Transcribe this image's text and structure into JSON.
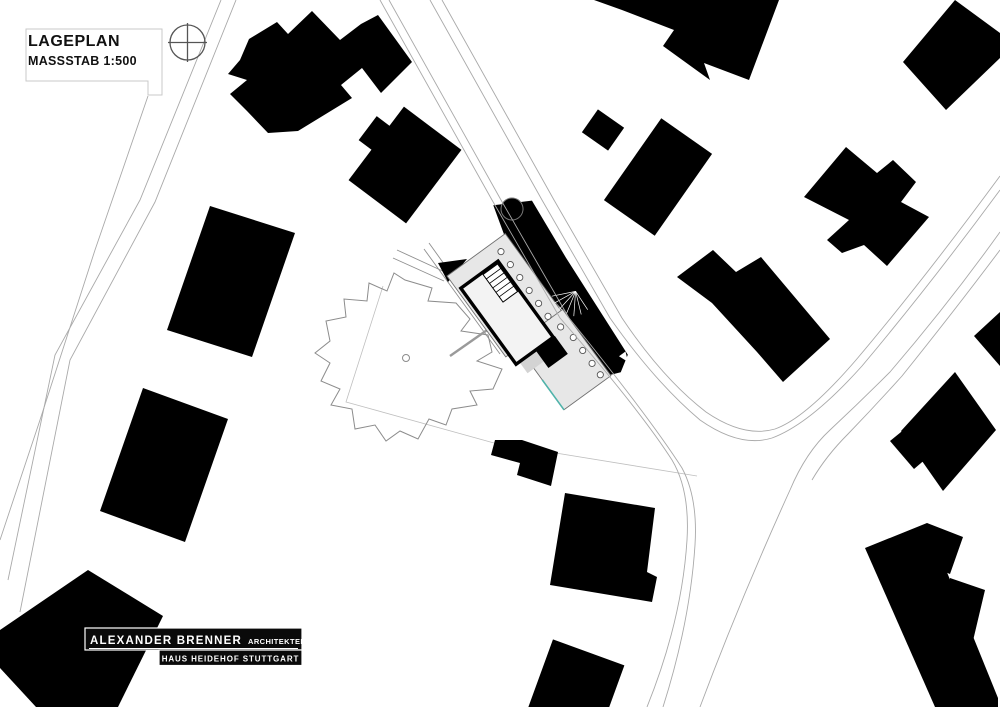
{
  "title_block": {
    "title": "LAGEPLAN",
    "scale": "MASSSTAB 1:500"
  },
  "stamp": {
    "firm": "ALEXANDER BRENNER",
    "firm_suffix": "ARCHITEKTEN",
    "project": "HAUS HEIDEHOF STUTTGART"
  },
  "icons": {
    "survey_marker": "crosshair-circle-icon"
  },
  "colors": {
    "background": "#ffffff",
    "building_fill": "#000000",
    "road_line": "#a9a9a9",
    "boundary_line": "#bfbfbf",
    "tree_line": "#8c8c8c",
    "roof_plate": "#e7e7e7",
    "terrace": "#d3d3d3",
    "pool_accent": "#4fb3aa",
    "text": "#111111",
    "stamp_bg": "#0a0a0a",
    "stamp_text": "#ffffff"
  }
}
